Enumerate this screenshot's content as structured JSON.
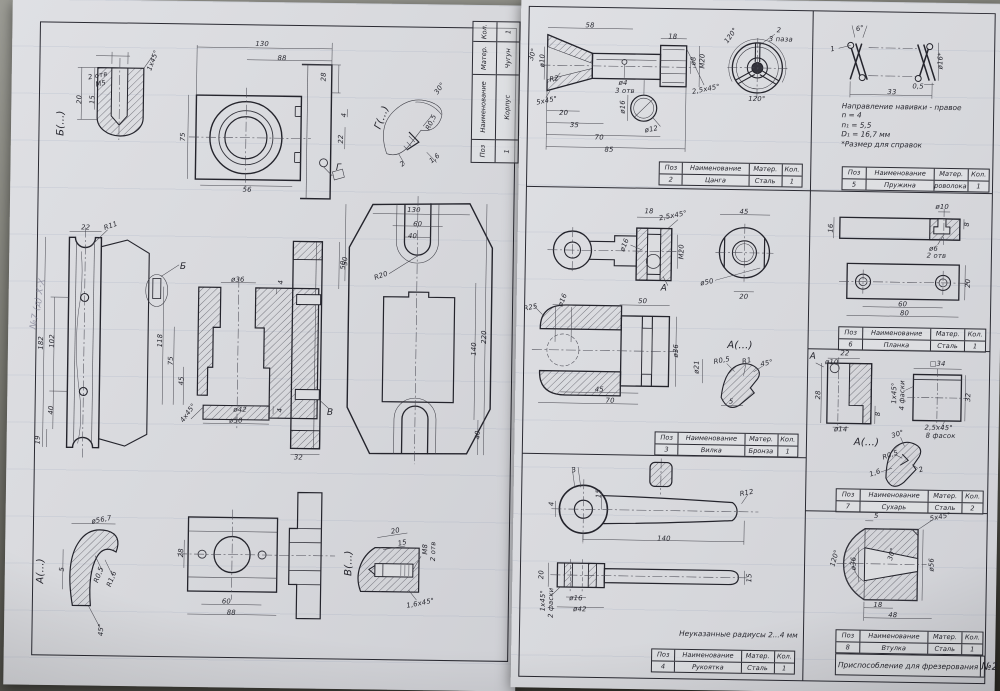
{
  "document": {
    "type": "engineering-drawing-scan",
    "title": "Приспособление для фрезерования",
    "sheet_number": "№2",
    "ink_color": "#26262e",
    "paper_color": "#d9dadd"
  },
  "table_headers": [
    "Поз",
    "Наименование",
    "Матер.",
    "Кол."
  ],
  "sheet1": {
    "titleblock": {
      "row": [
        "1",
        "Корпус",
        "Чугун",
        "1"
      ]
    },
    "handwriting": "№7 (д) Х·Х",
    "dims": [
      {
        "t": "Б(...)",
        "x": 50,
        "y": 124,
        "r": -90,
        "s": 10
      },
      {
        "t": "2 отв",
        "x": 86,
        "y": 76,
        "r": -12
      },
      {
        "t": "M5",
        "x": 89,
        "y": 84,
        "r": -12
      },
      {
        "t": "1x45°",
        "x": 141,
        "y": 60,
        "r": -70
      },
      {
        "t": "20",
        "x": 68,
        "y": 100,
        "r": -90
      },
      {
        "t": "15",
        "x": 81,
        "y": 100,
        "r": -90
      },
      {
        "t": "130",
        "x": 250,
        "y": 42
      },
      {
        "t": "88",
        "x": 270,
        "y": 56
      },
      {
        "t": "28",
        "x": 312,
        "y": 74,
        "r": -90
      },
      {
        "t": "75",
        "x": 172,
        "y": 136,
        "r": -90
      },
      {
        "t": "56",
        "x": 237,
        "y": 188
      },
      {
        "t": "22",
        "x": 330,
        "y": 136,
        "r": -90
      },
      {
        "t": "4",
        "x": 333,
        "y": 112,
        "r": -90
      },
      {
        "t": "Г",
        "x": 328,
        "y": 165,
        "s": 9
      },
      {
        "t": "Г(...)",
        "x": 371,
        "y": 114,
        "r": -70,
        "s": 10
      },
      {
        "t": "30°",
        "x": 428,
        "y": 84,
        "r": -55
      },
      {
        "t": "R0,5",
        "x": 420,
        "y": 118,
        "r": -65
      },
      {
        "t": "1,6",
        "x": 424,
        "y": 154,
        "r": -40
      },
      {
        "t": "2",
        "x": 392,
        "y": 160,
        "r": -40
      },
      {
        "t": "22",
        "x": 76,
        "y": 228
      },
      {
        "t": "R11",
        "x": 101,
        "y": 226,
        "r": -20
      },
      {
        "t": "182",
        "x": 33,
        "y": 344,
        "r": -90
      },
      {
        "t": "102",
        "x": 44,
        "y": 342,
        "r": -90
      },
      {
        "t": "40",
        "x": 44,
        "y": 411,
        "r": -90
      },
      {
        "t": "19",
        "x": 31,
        "y": 441,
        "r": -90
      },
      {
        "t": "Б",
        "x": 174,
        "y": 266,
        "s": 9
      },
      {
        "t": "ø36",
        "x": 229,
        "y": 278
      },
      {
        "t": "118",
        "x": 152,
        "y": 340,
        "r": -90
      },
      {
        "t": "75",
        "x": 163,
        "y": 360,
        "r": -90
      },
      {
        "t": "45",
        "x": 174,
        "y": 380,
        "r": -90
      },
      {
        "t": "4x45°",
        "x": 181,
        "y": 412,
        "r": -55
      },
      {
        "t": "ø42",
        "x": 233,
        "y": 408
      },
      {
        "t": "ø50",
        "x": 229,
        "y": 419
      },
      {
        "t": "4",
        "x": 273,
        "y": 408,
        "r": -90
      },
      {
        "t": "4",
        "x": 272,
        "y": 280,
        "r": -90
      },
      {
        "t": "В",
        "x": 323,
        "y": 410,
        "s": 9
      },
      {
        "t": "50",
        "x": 334,
        "y": 262,
        "r": -90
      },
      {
        "t": "32",
        "x": 292,
        "y": 455
      },
      {
        "t": "130",
        "x": 404,
        "y": 206
      },
      {
        "t": "60",
        "x": 408,
        "y": 220
      },
      {
        "t": "40",
        "x": 403,
        "y": 232
      },
      {
        "t": "R20",
        "x": 372,
        "y": 272,
        "r": -20
      },
      {
        "t": "50",
        "x": 336,
        "y": 258,
        "r": -90
      },
      {
        "t": "220",
        "x": 476,
        "y": 332,
        "r": -90
      },
      {
        "t": "140",
        "x": 466,
        "y": 344,
        "r": -90
      },
      {
        "t": "40",
        "x": 471,
        "y": 430,
        "r": -90
      },
      {
        "t": "А(...)",
        "x": 36,
        "y": 572,
        "r": -90,
        "s": 10
      },
      {
        "t": "ø56,7",
        "x": 96,
        "y": 520,
        "r": -12
      },
      {
        "t": "5",
        "x": 57,
        "y": 570,
        "r": -90
      },
      {
        "t": "R0,5",
        "x": 94,
        "y": 575,
        "r": -70
      },
      {
        "t": "R1,6",
        "x": 107,
        "y": 579,
        "r": -70
      },
      {
        "t": "45°",
        "x": 97,
        "y": 630,
        "r": -90
      },
      {
        "t": "28",
        "x": 176,
        "y": 552,
        "r": -90
      },
      {
        "t": "60",
        "x": 222,
        "y": 600
      },
      {
        "t": "88",
        "x": 227,
        "y": 611
      },
      {
        "t": "В(...)",
        "x": 344,
        "y": 560,
        "r": -90,
        "s": 10
      },
      {
        "t": "20",
        "x": 390,
        "y": 527,
        "r": -12
      },
      {
        "t": "15",
        "x": 397,
        "y": 539,
        "r": -12
      },
      {
        "t": "M8",
        "x": 420,
        "y": 545,
        "r": -90
      },
      {
        "t": "2 отв",
        "x": 428,
        "y": 547,
        "r": -90
      },
      {
        "t": "1,6x45°",
        "x": 416,
        "y": 599,
        "r": -12
      }
    ]
  },
  "sheet2": {
    "panels": {
      "collet": {
        "table": {
          "row": [
            "2",
            "Цанга",
            "Сталь",
            "1"
          ]
        },
        "dims": [
          {
            "t": "58",
            "x": 69,
            "y": 28
          },
          {
            "t": "18",
            "x": 152,
            "y": 38
          },
          {
            "t": "30°",
            "x": 12,
            "y": 58,
            "r": -75
          },
          {
            "t": "ø10",
            "x": 22,
            "y": 64,
            "r": -90
          },
          {
            "t": "R2",
            "x": 34,
            "y": 82,
            "r": -12
          },
          {
            "t": "5x45°",
            "x": 27,
            "y": 104,
            "r": -12
          },
          {
            "t": "20",
            "x": 44,
            "y": 116
          },
          {
            "t": "35",
            "x": 55,
            "y": 128
          },
          {
            "t": "70",
            "x": 80,
            "y": 140
          },
          {
            "t": "85",
            "x": 90,
            "y": 152
          },
          {
            "t": "ø4",
            "x": 103,
            "y": 85
          },
          {
            "t": "3 отв",
            "x": 105,
            "y": 93
          },
          {
            "t": "ø16",
            "x": 103,
            "y": 109,
            "r": -90
          },
          {
            "t": "ø12",
            "x": 132,
            "y": 131,
            "r": -12
          },
          {
            "t": "ø8",
            "x": 173,
            "y": 62,
            "r": -90
          },
          {
            "t": "M20",
            "x": 182,
            "y": 62,
            "r": -90
          },
          {
            "t": "2,5x45°",
            "x": 186,
            "y": 90,
            "r": -12
          },
          {
            "t": "120°",
            "x": 210,
            "y": 36,
            "r": -55
          },
          {
            "t": "120°",
            "x": 237,
            "y": 99
          },
          {
            "t": "2",
            "x": 258,
            "y": 30
          },
          {
            "t": "3 паза",
            "x": 260,
            "y": 39
          }
        ]
      },
      "spring": {
        "table": {
          "row": [
            "5",
            "Пружина",
            "Проволока 2",
            "1"
          ]
        },
        "notes": [
          "Направление навивки - правое",
          "n = 4",
          "n₁ = 5,5",
          "D₁ = 16,7 мм",
          "*Размер для справок"
        ],
        "dims": [
          {
            "t": "6°",
            "x": 339,
            "y": 27,
            "r": -12
          },
          {
            "t": "1",
            "x": 312,
            "y": 48,
            "r": -12
          },
          {
            "t": "ø16*",
            "x": 420,
            "y": 58,
            "r": -90
          },
          {
            "t": "0,5",
            "x": 398,
            "y": 84
          },
          {
            "t": "33",
            "x": 372,
            "y": 90
          }
        ]
      },
      "fork": {
        "table": {
          "row": [
            "3",
            "Вилка",
            "Бронза",
            "1"
          ]
        },
        "dims": [
          {
            "t": "18",
            "x": 131,
            "y": 213
          },
          {
            "t": "2,5x45°",
            "x": 155,
            "y": 217,
            "r": -12
          },
          {
            "t": "45",
            "x": 226,
            "y": 212
          },
          {
            "t": "ø16",
            "x": 107,
            "y": 247,
            "r": -70
          },
          {
            "t": "M20",
            "x": 164,
            "y": 253,
            "r": -90
          },
          {
            "t": "А",
            "x": 147,
            "y": 290,
            "s": 9
          },
          {
            "t": "ø50",
            "x": 190,
            "y": 283,
            "r": -12
          },
          {
            "t": "20",
            "x": 227,
            "y": 297
          },
          {
            "t": "R25",
            "x": 14,
            "y": 311,
            "r": -12
          },
          {
            "t": "ø16",
            "x": 46,
            "y": 303,
            "r": -70
          },
          {
            "t": "50",
            "x": 126,
            "y": 303
          },
          {
            "t": "ø36",
            "x": 160,
            "y": 352,
            "r": -90
          },
          {
            "t": "45",
            "x": 84,
            "y": 392
          },
          {
            "t": "70",
            "x": 95,
            "y": 403
          },
          {
            "t": "А(...)",
            "x": 224,
            "y": 346,
            "s": 10
          },
          {
            "t": "R0,5",
            "x": 206,
            "y": 361,
            "r": -12
          },
          {
            "t": "R1",
            "x": 231,
            "y": 361,
            "r": -12
          },
          {
            "t": "45°",
            "x": 251,
            "y": 363,
            "r": -12
          },
          {
            "t": "ø21",
            "x": 181,
            "y": 368,
            "r": -90
          },
          {
            "t": "5",
            "x": 216,
            "y": 402
          }
        ]
      },
      "handle": {
        "table": {
          "row": [
            "4",
            "Рукоятка",
            "Сталь",
            "1"
          ]
        },
        "note": "Неуказанные радиусы 2...4 мм",
        "dims": [
          {
            "t": "3",
            "x": 60,
            "y": 473,
            "r": -12
          },
          {
            "t": "15",
            "x": 85,
            "y": 496,
            "r": -90
          },
          {
            "t": "4",
            "x": 38,
            "y": 507,
            "r": -90
          },
          {
            "t": "R12",
            "x": 233,
            "y": 493,
            "r": -12
          },
          {
            "t": "140",
            "x": 151,
            "y": 540
          },
          {
            "t": "20",
            "x": 29,
            "y": 578,
            "r": -90
          },
          {
            "t": "1x45°",
            "x": 31,
            "y": 604,
            "r": -90
          },
          {
            "t": "2 фаски",
            "x": 39,
            "y": 606,
            "r": -90
          },
          {
            "t": "ø16",
            "x": 64,
            "y": 601
          },
          {
            "t": "ø42",
            "x": 68,
            "y": 612
          },
          {
            "t": "15",
            "x": 237,
            "y": 578,
            "r": -90
          }
        ]
      },
      "planka": {
        "table": {
          "row": [
            "6",
            "Планка",
            "Сталь",
            "1"
          ]
        },
        "dims": [
          {
            "t": "ø10",
            "x": 424,
            "y": 204
          },
          {
            "t": "16",
            "x": 313,
            "y": 227,
            "r": -90
          },
          {
            "t": "ø6",
            "x": 416,
            "y": 246
          },
          {
            "t": "2 отв",
            "x": 419,
            "y": 253
          },
          {
            "t": "8",
            "x": 449,
            "y": 221,
            "r": -90
          },
          {
            "t": "20",
            "x": 451,
            "y": 280,
            "r": -90
          },
          {
            "t": "60",
            "x": 386,
            "y": 302
          },
          {
            "t": "80",
            "x": 388,
            "y": 311
          }
        ]
      },
      "sukhar": {
        "table": {
          "row": [
            "7",
            "Сухарь",
            "Сталь",
            "2"
          ]
        },
        "dims": [
          {
            "t": "А",
            "x": 297,
            "y": 356,
            "s": 9
          },
          {
            "t": "22",
            "x": 329,
            "y": 352
          },
          {
            "t": "ø10",
            "x": 316,
            "y": 361
          },
          {
            "t": "ø14",
            "x": 326,
            "y": 428
          },
          {
            "t": "8",
            "x": 363,
            "y": 412,
            "r": -90
          },
          {
            "t": "28",
            "x": 303,
            "y": 394,
            "r": -90
          },
          {
            "t": "□34",
            "x": 422,
            "y": 361
          },
          {
            "t": "1x45°",
            "x": 379,
            "y": 391,
            "r": -90
          },
          {
            "t": "4 фаски",
            "x": 387,
            "y": 393,
            "r": -90
          },
          {
            "t": "32",
            "x": 453,
            "y": 394,
            "r": -90
          },
          {
            "t": "2,5x45°",
            "x": 424,
            "y": 425
          },
          {
            "t": "8 фасок",
            "x": 426,
            "y": 433
          },
          {
            "t": "А(...)",
            "x": 352,
            "y": 441,
            "s": 10
          },
          {
            "t": "30°",
            "x": 383,
            "y": 432,
            "r": -20
          },
          {
            "t": "R0,5",
            "x": 376,
            "y": 453,
            "r": -20
          },
          {
            "t": "1,6",
            "x": 361,
            "y": 471,
            "r": -20
          },
          {
            "t": "2",
            "x": 407,
            "y": 467,
            "r": -20
          }
        ]
      },
      "vtulka": {
        "table": {
          "row": [
            "8",
            "Втулка",
            "Сталь",
            "1"
          ]
        },
        "dims": [
          {
            "t": "5",
            "x": 363,
            "y": 514
          },
          {
            "t": "5x45°",
            "x": 427,
            "y": 514,
            "r": -12
          },
          {
            "t": "120°",
            "x": 322,
            "y": 557,
            "r": -75
          },
          {
            "t": "ø36",
            "x": 341,
            "y": 562,
            "r": -90
          },
          {
            "t": "30°",
            "x": 379,
            "y": 552,
            "r": -75
          },
          {
            "t": "ø56",
            "x": 419,
            "y": 562,
            "r": -90
          },
          {
            "t": "18",
            "x": 366,
            "y": 603
          },
          {
            "t": "48",
            "x": 381,
            "y": 613
          }
        ]
      }
    },
    "title": {
      "name": "Приспособление для фрезерования",
      "number": "№2"
    }
  }
}
